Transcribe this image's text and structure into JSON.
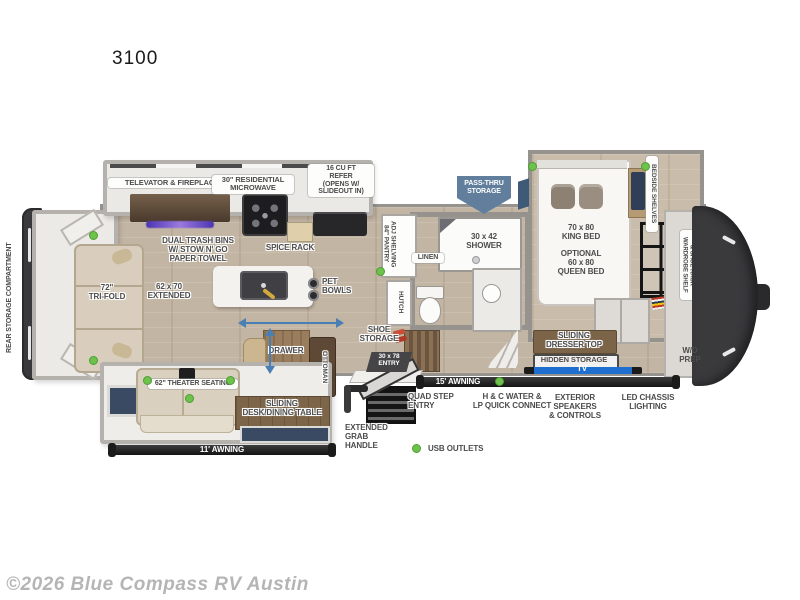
{
  "title": "3100",
  "footer": {
    "copyright": "©2026 Blue Compass RV Austin"
  },
  "legend": {
    "usb_outlets": "USB OUTLETS"
  },
  "colors": {
    "usb_dot_green": "#6cc24a",
    "pass_thru_blue": "#617f9d",
    "slide_arrow_blue": "#4a7fb5",
    "awning_bar_black": "#262626",
    "fireplace_glow_purple": "#7b5fd6"
  },
  "floorplan": {
    "rear": {
      "storage_compartment": "REAR STORAGE COMPARTMENT",
      "sofa": "72\"\nTRI-FOLD",
      "sofa_slide": "62 x 70\nEXTENDED"
    },
    "kitchen": {
      "televator": "TELEVATOR & FIREPLACE",
      "microwave": "30\" RESIDENTIAL\nMICROWAVE",
      "refrigerator": "16 CU FT\nREFER\n(OPENS W/\nSLIDEOUT IN)",
      "dual_trash": "DUAL TRASH BINS\nW/ STOW N' GO\nPAPER TOWEL",
      "spice_rack": "SPICE RACK",
      "pet_bowls": "PET\nBOWLS"
    },
    "living": {
      "theater_seating": "62\" THEATER SEATING",
      "desk_table": "SLIDING\nDESK/DINING TABLE",
      "drawer": "DRAWER",
      "ottoman": "OTTOMAN"
    },
    "entry": {
      "shoe_storage": "SHOE\nSTORAGE",
      "entry_door": "30 x 78\nENTRY",
      "pantry": "84\" PANTRY\nADJ SHELVING",
      "hutch": "HUTCH"
    },
    "bath": {
      "linen": "LINEN",
      "shower": "30 x 42\nSHOWER"
    },
    "bedroom": {
      "pass_thru": "PASS-THRU\nSTORAGE",
      "king_bed": "70 x 80\nKING BED",
      "queen_option": "OPTIONAL\n60 x 80\nQUEEN BED",
      "bedside_shelves": "BEDSIDE SHELVES",
      "wardrobe": "WARDROBE SHELF\n& SHOE RACK",
      "sliding_dresser": "SLIDING\nDRESSER TOP",
      "hidden_storage": "HIDDEN STORAGE",
      "tv": "TV",
      "wd_prep": "W/D\nPREP"
    },
    "exterior": {
      "awning_15": "15' AWNING",
      "awning_11": "11' AWNING",
      "quad_step": "QUAD STEP\nENTRY",
      "water_lp": "H & C WATER &\nLP QUICK CONNECT",
      "speakers": "EXTERIOR SPEAKERS\n& CONTROLS",
      "led_lighting": "LED CHASSIS\nLIGHTING",
      "grab_handle": "EXTENDED\nGRAB\nHANDLE"
    }
  }
}
